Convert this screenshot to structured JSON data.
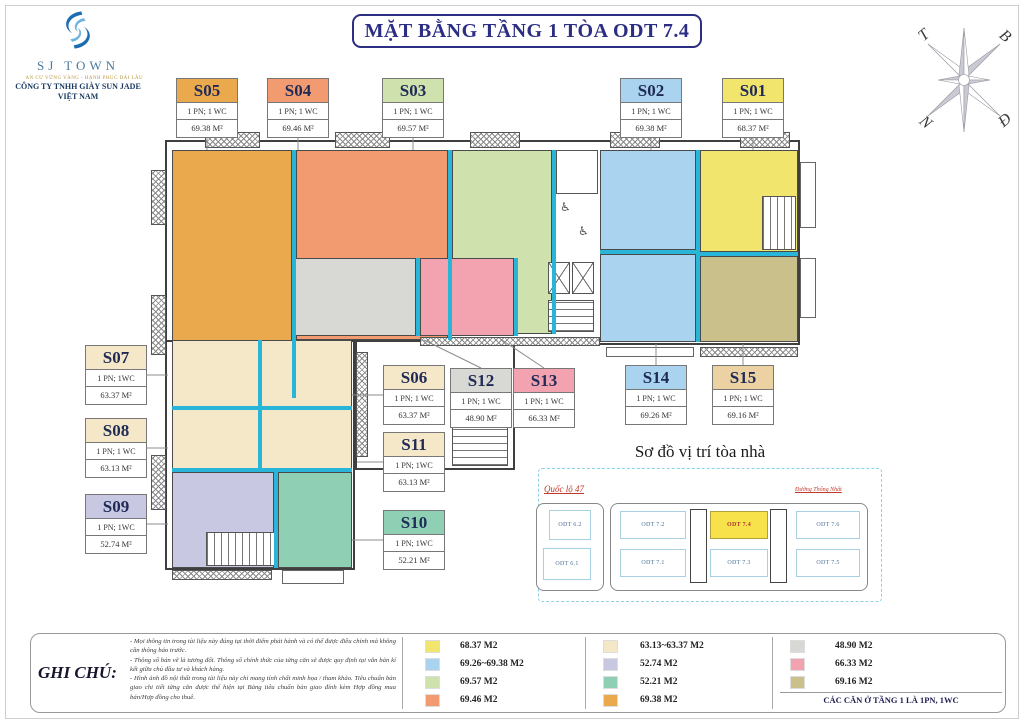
{
  "title": "MẶT BẰNG TẦNG 1 TÒA ODT 7.4",
  "logo": {
    "name": "SJ TOWN",
    "tagline": "AN CƯ VỮNG VÀNG - HẠNH PHÚC DÀI LÂU",
    "company": "CÔNG TY TNHH GIÀY SUN JADE",
    "country": "VIỆT NAM"
  },
  "compass": {
    "north": "B",
    "east": "Đ",
    "south": "N",
    "west": "T"
  },
  "icons": {
    "wheelchair": "♿"
  },
  "accent": {
    "title_color": "#2b2e83",
    "cyan_divider": "#29b5d8"
  },
  "units": {
    "s01": {
      "label": "S01",
      "pn": "1 PN; 1 WC",
      "area": "68.37 M²",
      "color": "#f2e56d",
      "fill": "#f2e56d"
    },
    "s02": {
      "label": "S02",
      "pn": "1 PN; 1 WC",
      "area": "69.38 M²",
      "color": "#a9d3ee",
      "fill": "#a9d3ee"
    },
    "s03": {
      "label": "S03",
      "pn": "1 PN; 1 WC",
      "area": "69.57 M²",
      "color": "#cfe2ad",
      "fill": "#cfe2ad"
    },
    "s04": {
      "label": "S04",
      "pn": "1 PN; 1 WC",
      "area": "69.46 M²",
      "color": "#f29b71",
      "fill": "#f29b71"
    },
    "s05": {
      "label": "S05",
      "pn": "1 PN; 1 WC",
      "area": "69.38 M²",
      "color": "#eba94e",
      "fill": "#eba94e"
    },
    "s06": {
      "label": "S06",
      "pn": "1 PN; 1 WC",
      "area": "63.37 M²",
      "color": "#f5e8c8",
      "fill": "#f5e8c8"
    },
    "s07": {
      "label": "S07",
      "pn": "1 PN; 1WC",
      "area": "63.37 M²",
      "color": "#f5e8c8",
      "fill": "#f5e8c8"
    },
    "s08": {
      "label": "S08",
      "pn": "1 PN; 1 WC",
      "area": "63.13 M²",
      "color": "#f5e8c8",
      "fill": "#f5e8c8"
    },
    "s09": {
      "label": "S09",
      "pn": "1 PN; 1WC",
      "area": "52.74 M²",
      "color": "#c9c8e2",
      "fill": "#c9c8e2"
    },
    "s10": {
      "label": "S10",
      "pn": "1 PN; 1WC",
      "area": "52.21 M²",
      "color": "#8fd0b4",
      "fill": "#8fd0b4"
    },
    "s11": {
      "label": "S11",
      "pn": "1 PN; 1WC",
      "area": "63.13 M²",
      "color": "#f5e8c8",
      "fill": "#f5e8c8"
    },
    "s12": {
      "label": "S12",
      "pn": "1 PN; 1 WC",
      "area": "48.90 M²",
      "color": "#d8d8d4",
      "fill": "#d8d8d4"
    },
    "s13": {
      "label": "S13",
      "pn": "1 PN; 1 WC",
      "area": "66.33 M²",
      "color": "#f3a2b0",
      "fill": "#f3a2b0"
    },
    "s14": {
      "label": "S14",
      "pn": "1 PN; 1 WC",
      "area": "69.26 M²",
      "color": "#a9d3ee",
      "fill": "#a9d3ee"
    },
    "s15": {
      "label": "S15",
      "pn": "1 PN; 1 WC",
      "area": "69.16 M²",
      "color": "#ecd2a2",
      "fill": "#c9c08c"
    }
  },
  "location_map": {
    "title": "Sơ đồ vị trí tòa nhà",
    "road_left": "Quốc lộ 47",
    "road_right": "Đường Thống Nhất",
    "buildings": {
      "odt62": "ODT 6.2",
      "odt61": "ODT 6.1",
      "odt72": "ODT 7.2",
      "odt74": "ODT 7.4",
      "odt76": "ODT 7.6",
      "odt71": "ODT 7.1",
      "odt73": "ODT 7.3",
      "odt75": "ODT 7.5"
    },
    "highlighted": "ODT 7.4",
    "highlight_color": "#f7e24b"
  },
  "legend": {
    "heading": "GHI CHÚ:",
    "notes": [
      "- Mọi thông tin trong tài liệu này đúng tại thời điểm phát hành và có thể được điều chỉnh mà không cần thông báo trước.",
      "- Thông số bản vẽ là tương đối. Thông số chính thức của từng căn sẽ được quy định tại văn bản kí kết giữa chủ đầu tư và khách hàng.",
      "- Hình ảnh đồ nội thất trong tài liệu này chỉ mang tính chất minh họa / tham khảo. Tiêu chuẩn bàn giao chi tiết từng căn được thể hiện tại Bảng tiêu chuẩn bàn giao đính kèm Hợp đồng mua bán/Hợp đồng cho thuê."
    ],
    "columns": [
      [
        {
          "color": "#f2e56d",
          "label": "68.37 M2"
        },
        {
          "color": "#a9d3ee",
          "label": "69.26~69.38 M2"
        },
        {
          "color": "#cfe2ad",
          "label": "69.57 M2"
        },
        {
          "color": "#f29b71",
          "label": "69.46 M2"
        }
      ],
      [
        {
          "color": "#f5e8c8",
          "label": "63.13~63.37 M2"
        },
        {
          "color": "#c9c8e2",
          "label": "52.74 M2"
        },
        {
          "color": "#8fd0b4",
          "label": "52.21 M2"
        },
        {
          "color": "#eba94e",
          "label": "69.38 M2"
        }
      ],
      [
        {
          "color": "#d8d8d4",
          "label": "48.90 M2"
        },
        {
          "color": "#f3a2b0",
          "label": "66.33 M2"
        },
        {
          "color": "#c9c08c",
          "label": "69.16 M2"
        }
      ]
    ],
    "footnote": "CÁC CĂN Ở TẦNG 1 LÀ 1PN, 1WC"
  }
}
